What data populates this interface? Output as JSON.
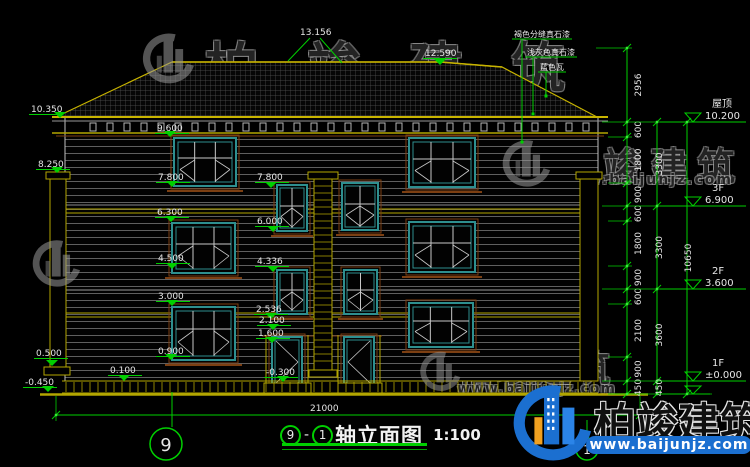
{
  "title": {
    "bubble_start": "9",
    "bubble_end": "1",
    "dash": "-",
    "text": "轴立面图",
    "scale": "1:100"
  },
  "grid_bubbles": {
    "left": "9",
    "right": "1"
  },
  "watermark": {
    "brand": "柏竣建筑",
    "url": "www.baijunjz.com"
  },
  "colors": {
    "green": "#00cf00",
    "yellow": "#b3a600",
    "teal": "#2e8f8f",
    "brown": "#7c3f12",
    "white": "#e6e6e6",
    "blue": "#1b6fd0",
    "orange": "#f0a020"
  },
  "annotations": {
    "markers": [
      {
        "value": "13.156",
        "tx": 300,
        "ty": 35,
        "type": "peak",
        "lines": [
          [
            310,
            38,
            288,
            61
          ],
          [
            320,
            38,
            342,
            63
          ]
        ]
      },
      {
        "value": "12.590",
        "tx": 425,
        "ty": 56,
        "tipx": 440,
        "tipy": 65
      },
      {
        "value": "10.350",
        "tx": 31,
        "ty": 112,
        "tipx": 60,
        "tipy": 118
      },
      {
        "value": "9.600",
        "tx": 157,
        "ty": 131,
        "tipx": 170,
        "tipy": 137
      },
      {
        "value": "8.250",
        "tx": 38,
        "ty": 167,
        "tipx": 57,
        "tipy": 173
      },
      {
        "value": "7.800",
        "tx": 158,
        "ty": 180,
        "tipx": 172,
        "tipy": 187
      },
      {
        "value": "7.800",
        "tx": 257,
        "ty": 180,
        "tipx": 271,
        "tipy": 188
      },
      {
        "value": "6.300",
        "tx": 157,
        "ty": 215,
        "tipx": 171,
        "tipy": 222
      },
      {
        "value": "6.000",
        "tx": 257,
        "ty": 224,
        "tipx": 273,
        "tipy": 232
      },
      {
        "value": "4.500",
        "tx": 158,
        "ty": 261,
        "tipx": 172,
        "tipy": 269
      },
      {
        "value": "4.336",
        "tx": 257,
        "ty": 264,
        "tipx": 273,
        "tipy": 272
      },
      {
        "value": "3.000",
        "tx": 158,
        "ty": 299,
        "tipx": 172,
        "tipy": 306
      },
      {
        "value": "2.536",
        "tx": 256,
        "ty": 312,
        "tipx": 271,
        "tipy": 319
      },
      {
        "value": "2.100",
        "tx": 259,
        "ty": 323,
        "tipx": 273,
        "tipy": 330
      },
      {
        "value": "1.600",
        "tx": 258,
        "ty": 336,
        "tipx": 272,
        "tipy": 343
      },
      {
        "value": "0.900",
        "tx": 158,
        "ty": 354,
        "tipx": 171,
        "tipy": 360
      },
      {
        "value": "0.500",
        "tx": 36,
        "ty": 356,
        "tipx": 52,
        "tipy": 366
      },
      {
        "value": "0.100",
        "tx": 110,
        "ty": 373,
        "tipx": 124,
        "tipy": 381
      },
      {
        "value": "-0.450",
        "tx": 25,
        "ty": 385,
        "tipx": 48,
        "tipy": 392
      },
      {
        "value": "-0.300",
        "tx": 266,
        "ty": 375,
        "tipx": 283,
        "tipy": 382
      }
    ],
    "materials": [
      {
        "text": "褐色分缝真石漆",
        "tx": 514,
        "ty": 37,
        "lx": 522,
        "ly1": 40,
        "ly2": 142
      },
      {
        "text": "浅灰色真石漆",
        "tx": 527,
        "ty": 55,
        "lx": 533,
        "ly1": 58,
        "ly2": 114
      },
      {
        "text": "蓝色瓦",
        "tx": 540,
        "ty": 70,
        "lx": 546,
        "ly1": 72,
        "ly2": 96
      }
    ],
    "levels": [
      {
        "name": "屋顶",
        "value": "10.200",
        "y": 122
      },
      {
        "name": "3F",
        "value": "6.900",
        "y": 206
      },
      {
        "name": "2F",
        "value": "3.600",
        "y": 289
      },
      {
        "name": "1F",
        "value": "±0.000",
        "y": 381
      }
    ],
    "ground_y": 394,
    "chains": [
      {
        "x": 627,
        "lx": 641,
        "ticks": [
          48,
          122,
          137,
          183,
          206,
          221,
          266,
          289,
          304,
          357,
          381,
          394
        ],
        "labels": [
          "2956",
          "600",
          "1800",
          "900",
          "600",
          "1800",
          "900",
          "600",
          "2100",
          "900",
          "450"
        ]
      },
      {
        "x": 657,
        "lx": 662,
        "ticks": [
          122,
          206,
          289,
          381,
          394
        ],
        "labels": [
          "3300",
          "3300",
          "3600",
          "450"
        ]
      },
      {
        "x": 687,
        "lx": 691,
        "ticks": [
          122,
          394
        ],
        "labels": [
          "10650"
        ]
      }
    ],
    "total_dim": {
      "label": "21000",
      "y": 415,
      "x1": 56,
      "x2": 640,
      "tx": 310,
      "ty": 411
    }
  }
}
